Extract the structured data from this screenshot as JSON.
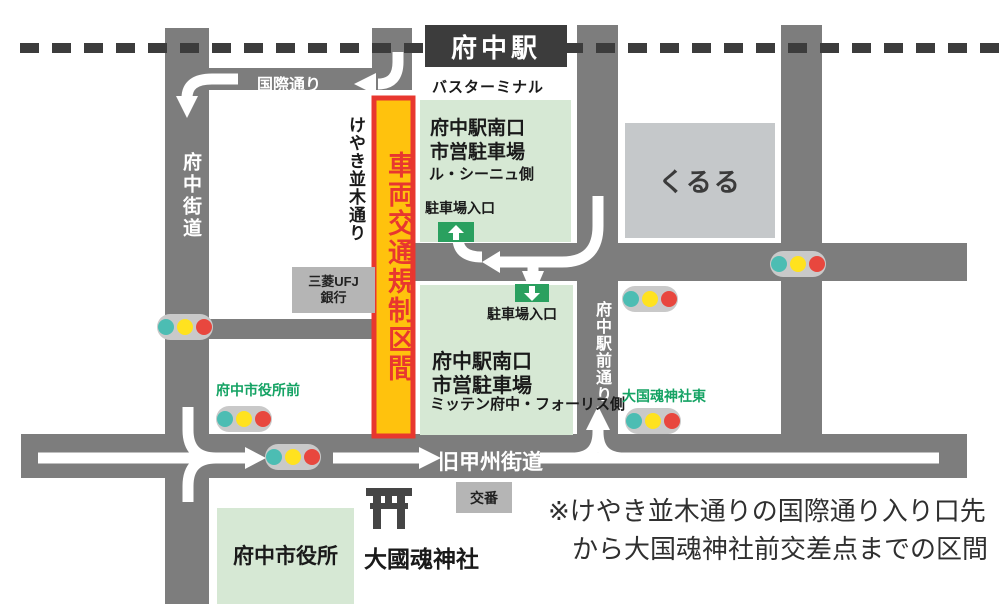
{
  "station": {
    "label": "府中駅"
  },
  "busTerminal": "バスターミナル",
  "roads": {
    "fuchuKaido": "府中街道",
    "kokusaiDori": "国際通り",
    "keyakiNamikiDori": "けやき並木通り",
    "fuchuEkimaeDori": "府中駅前通り",
    "kyuKoshuKaido": "旧甲州街道"
  },
  "restrictedZone": {
    "label": "車両交通規制区間"
  },
  "parkingNorth": {
    "name1": "府中駅南口",
    "name2": "市営駐車場",
    "side": "ル・シーニュ側",
    "entrance": "駐車場入口"
  },
  "parkingSouth": {
    "name1": "府中駅南口",
    "name2": "市営駐車場",
    "side": "ミッテン府中・フォーリス側",
    "entrance": "駐車場入口"
  },
  "buildings": {
    "kururu": "くるる",
    "bank1": "三菱UFJ",
    "bank2": "銀行",
    "koban": "交番",
    "cityHall": "府中市役所",
    "shrine": "大國魂神社"
  },
  "signalLabels": {
    "cityHallFront": "府中市役所前",
    "okunitamaEast": "大国魂神社東"
  },
  "note": {
    "line1": "※けやき並木通りの国際通り入り口先",
    "line2": "から大国魂神社前交差点までの区間"
  },
  "colors": {
    "road": "#7d7d7d",
    "dark": "#3c3c3c",
    "zoneFill": "#ffc20d",
    "zoneBorder": "#e8372f",
    "parkingBg": "#d6e8d4",
    "entranceGreen": "#2aa05f",
    "signalGreenText": "#15a364",
    "lampTeal": "#4cbdb3",
    "lampYellow": "#ffe21f",
    "lampRed": "#e8473e"
  }
}
